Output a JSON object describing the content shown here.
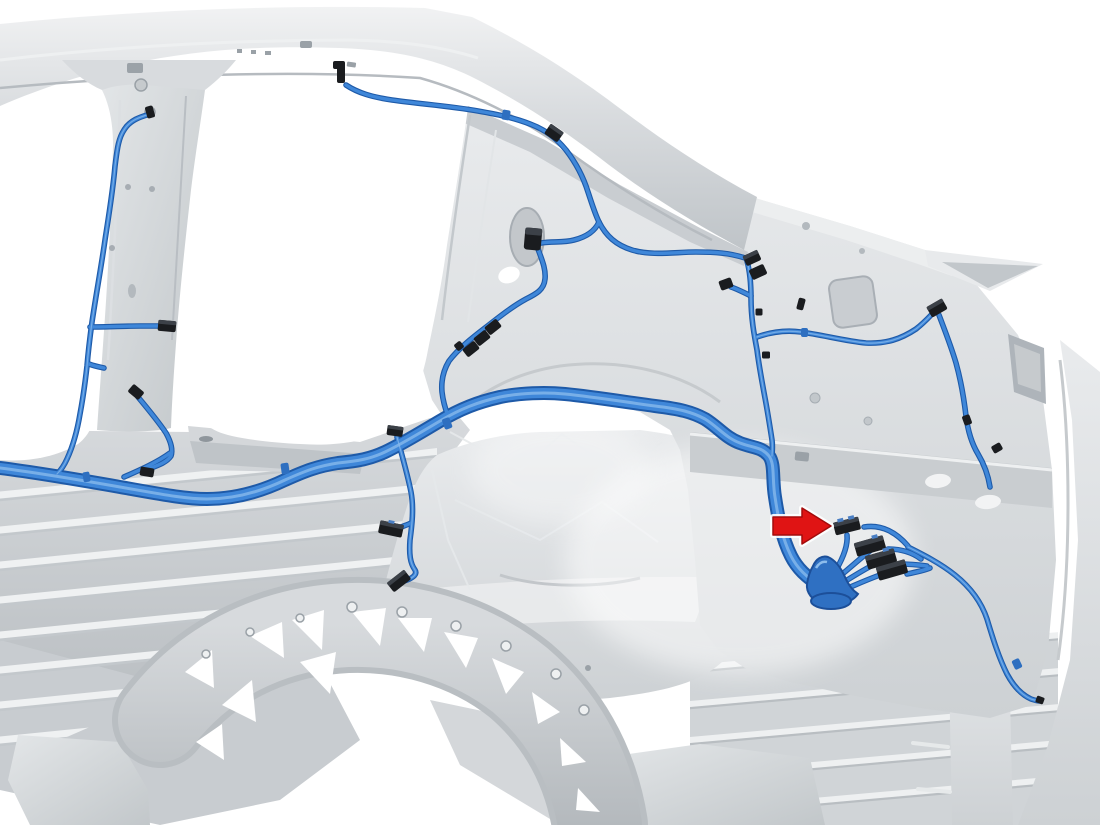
{
  "figure": {
    "kind": "technical-illustration",
    "subject": "vehicle body rear structure with highlighted low-voltage wiring harness",
    "view": "rear three-quarter cutaway, body-in-white",
    "background": "#ffffff",
    "text_labels": []
  },
  "palette": {
    "body_light": "#e9ebed",
    "body_mid": "#d3d6d9",
    "body_shade": "#b7bcc0",
    "body_line": "#9aa1a7",
    "rib_light": "#eff1f2",
    "harness_blue": "#3f87d9",
    "harness_outline": "#1e5aa8",
    "harness_highlight": "#8cbcec",
    "clip_blue": "#2e6fc0",
    "grommet_blue": "#2f70c2",
    "connector_black": "#1a1c1f",
    "connector_top": "#3c4148",
    "arrow_red": "#e01414",
    "arrow_red_dark": "#a30c0c"
  },
  "harness": {
    "name": "low-voltage harness (highlighted blue)",
    "routes": [
      "roof-rail",
      "b-pillar",
      "rocker-floor-trunk",
      "c-pillar-branch",
      "quarter-panel-branches",
      "rear-connector-cluster",
      "lower-rear-run"
    ],
    "grommet": "floor-pass-through"
  },
  "callout": {
    "icon": "arrow-right-icon",
    "points_to": "first connector of rear harness connector cluster",
    "cluster_connector_count": 4
  }
}
